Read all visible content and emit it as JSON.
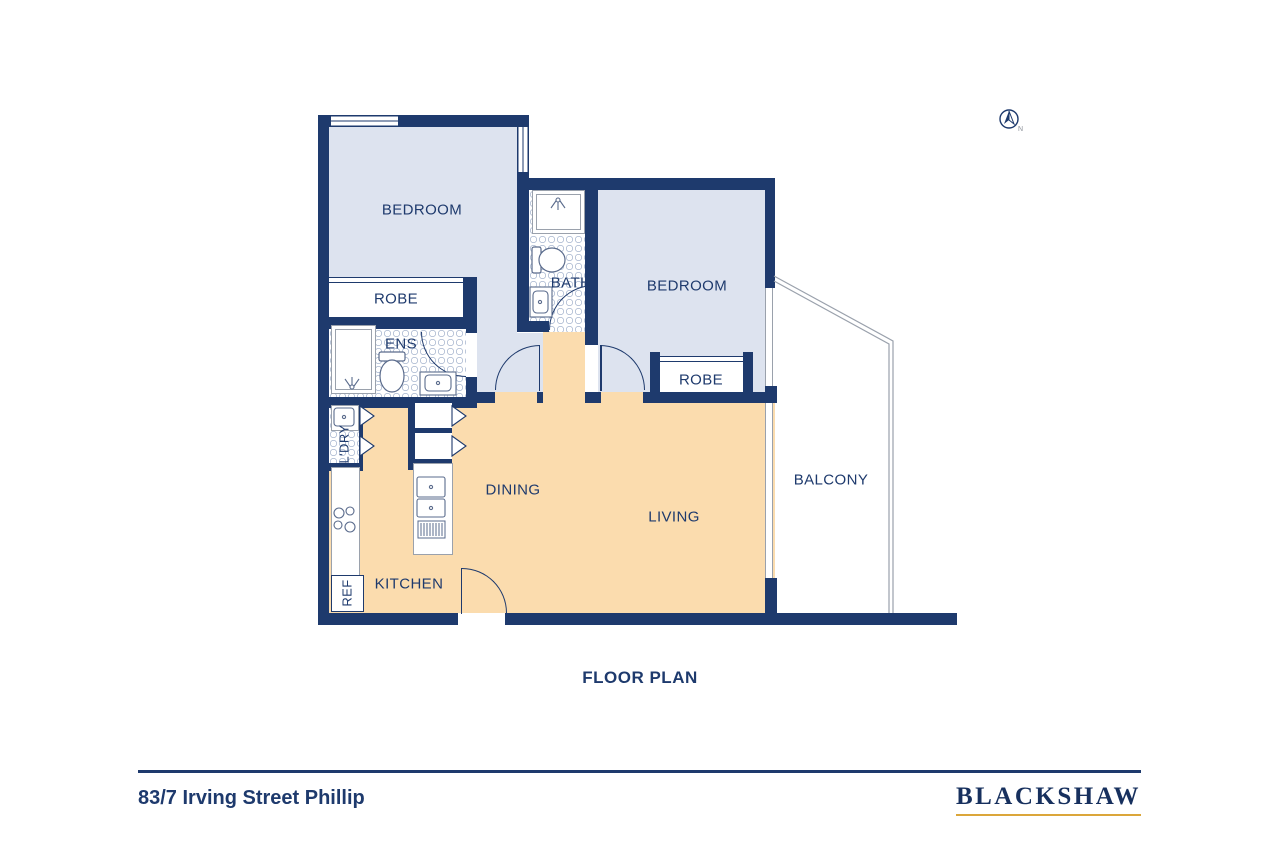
{
  "title": "FLOOR PLAN",
  "compass": {
    "north_label": "N"
  },
  "rooms": {
    "bedroom_left": "BEDROOM",
    "robe_left": "ROBE",
    "ens": "ENS",
    "bath": "BATH",
    "bedroom_right": "BEDROOM",
    "robe_right": "ROBE",
    "laundry": "L'DRY",
    "kitchen": "KITCHEN",
    "fridge": "REF",
    "dining": "DINING",
    "living": "LIVING",
    "balcony": "BALCONY"
  },
  "footer": {
    "address": "83/7 Irving Street Phillip",
    "brand": "BLACKSHAW"
  },
  "colors": {
    "wall": "#1e3a6d",
    "bed": "#dde3ef",
    "peach": "#fbdcae",
    "gold": "#dba63a",
    "line": "#9aa1ac",
    "fix": "#5a6b8c"
  }
}
